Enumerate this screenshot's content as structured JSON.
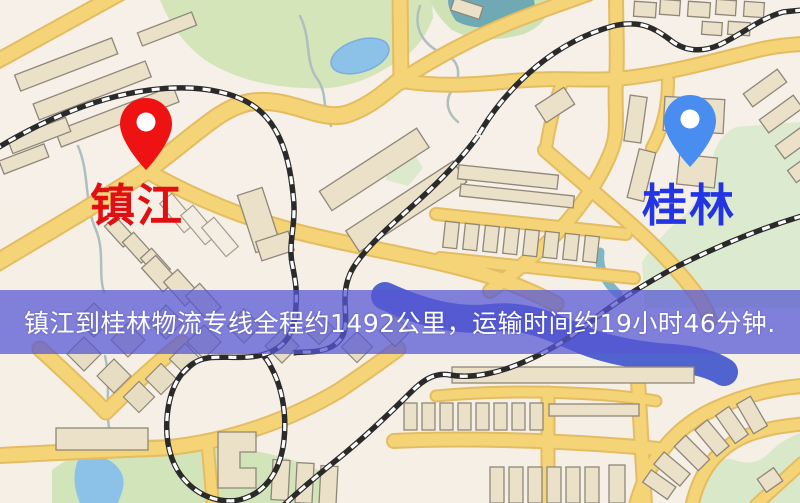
{
  "banner": {
    "text": "镇江到桂林物流专线全程约1492公里，运输时间约19小时46分钟.",
    "background_color": "#5658d4",
    "text_color": "#ffffff"
  },
  "route": {
    "origin": "镇江",
    "destination": "桂林",
    "distance_text": "约1492公里",
    "duration_text": "约19小时46分钟"
  },
  "markers": [
    {
      "id": "origin",
      "label": "镇江",
      "pin_color": "#ee1212",
      "label_color": "#e01012"
    },
    {
      "id": "destination",
      "label": "桂林",
      "pin_color": "#4a8df0",
      "label_color": "#2334e4"
    }
  ],
  "map_palette": {
    "background": "#f5efe6",
    "road": "#f5d478",
    "road_casing": "#e4bc62",
    "park": "#d4e5ba",
    "park_pale": "#dcead0",
    "water_light": "#8cc2e8",
    "river": "#5163ce",
    "stream": "#aebfbf",
    "building": "#eae1c8",
    "building_outline": "#8f8779",
    "railway": "#2a2a2a"
  }
}
